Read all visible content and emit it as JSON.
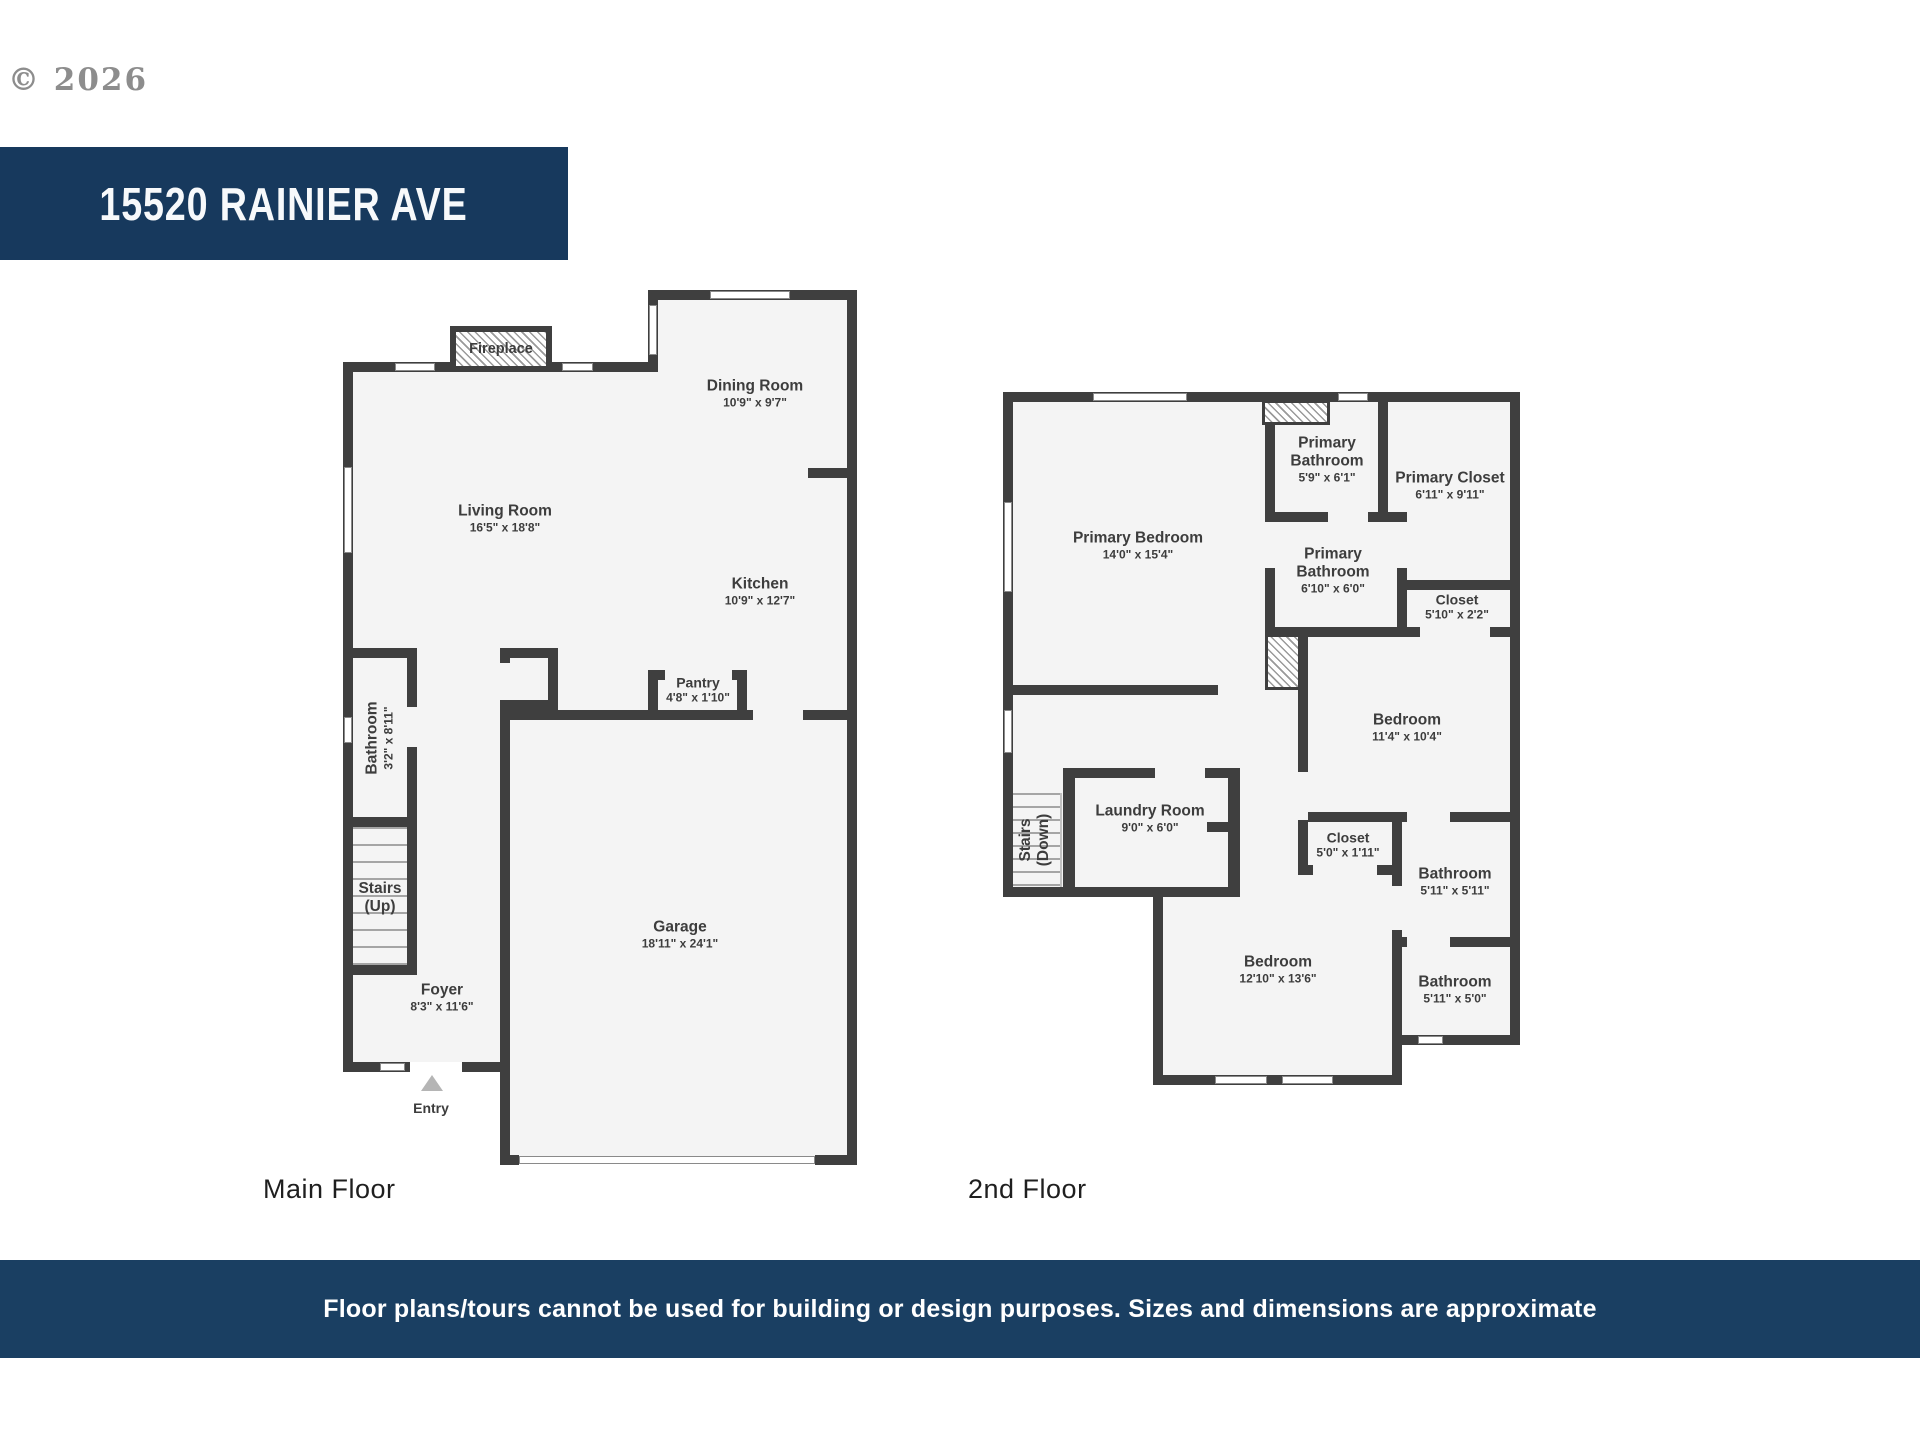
{
  "header": {
    "copyright": "© 2026",
    "address": "15520 RAINIER AVE"
  },
  "floor_labels": {
    "main": "Main Floor",
    "second": "2nd Floor"
  },
  "footer": {
    "disclaimer": "Floor plans/tours cannot be used for building or design purposes. Sizes and dimensions are approximate"
  },
  "main_floor": {
    "fireplace": "Fireplace",
    "rooms": {
      "living": {
        "name": "Living Room",
        "dims": "16'5\" x 18'8\""
      },
      "dining": {
        "name": "Dining Room",
        "dims": "10'9\" x 9'7\""
      },
      "kitchen": {
        "name": "Kitchen",
        "dims": "10'9\" x 12'7\""
      },
      "pantry": {
        "name": "Pantry",
        "dims": "4'8\" x 1'10\""
      },
      "bathroom": {
        "name": "Bathroom",
        "dims": "3'2\" x 8'11\""
      },
      "stairs": {
        "name": "Stairs",
        "dims": "(Up)"
      },
      "foyer": {
        "name": "Foyer",
        "dims": "8'3\" x 11'6\""
      },
      "garage": {
        "name": "Garage",
        "dims": "18'11\" x 24'1\""
      },
      "entry": {
        "name": "Entry"
      }
    }
  },
  "second_floor": {
    "rooms": {
      "primary_bedroom": {
        "name": "Primary Bedroom",
        "dims": "14'0\" x 15'4\""
      },
      "primary_bathroom_1": {
        "name": "Primary Bathroom",
        "dims": "5'9\" x 6'1\""
      },
      "primary_closet": {
        "name": "Primary Closet",
        "dims": "6'11\" x 9'11\""
      },
      "primary_bathroom_2": {
        "name": "Primary Bathroom",
        "dims": "6'10\" x 6'0\""
      },
      "closet_1": {
        "name": "Closet",
        "dims": "5'10\" x 2'2\""
      },
      "bedroom_1": {
        "name": "Bedroom",
        "dims": "11'4\" x 10'4\""
      },
      "laundry": {
        "name": "Laundry Room",
        "dims": "9'0\" x 6'0\""
      },
      "stairs": {
        "name": "Stairs",
        "dims": "(Down)"
      },
      "closet_2": {
        "name": "Closet",
        "dims": "5'0\" x 1'11\""
      },
      "bathroom_1": {
        "name": "Bathroom",
        "dims": "5'11\" x 5'11\""
      },
      "bathroom_2": {
        "name": "Bathroom",
        "dims": "5'11\" x 5'0\""
      },
      "bedroom_2": {
        "name": "Bedroom",
        "dims": "12'10\" x 13'6\""
      }
    }
  }
}
